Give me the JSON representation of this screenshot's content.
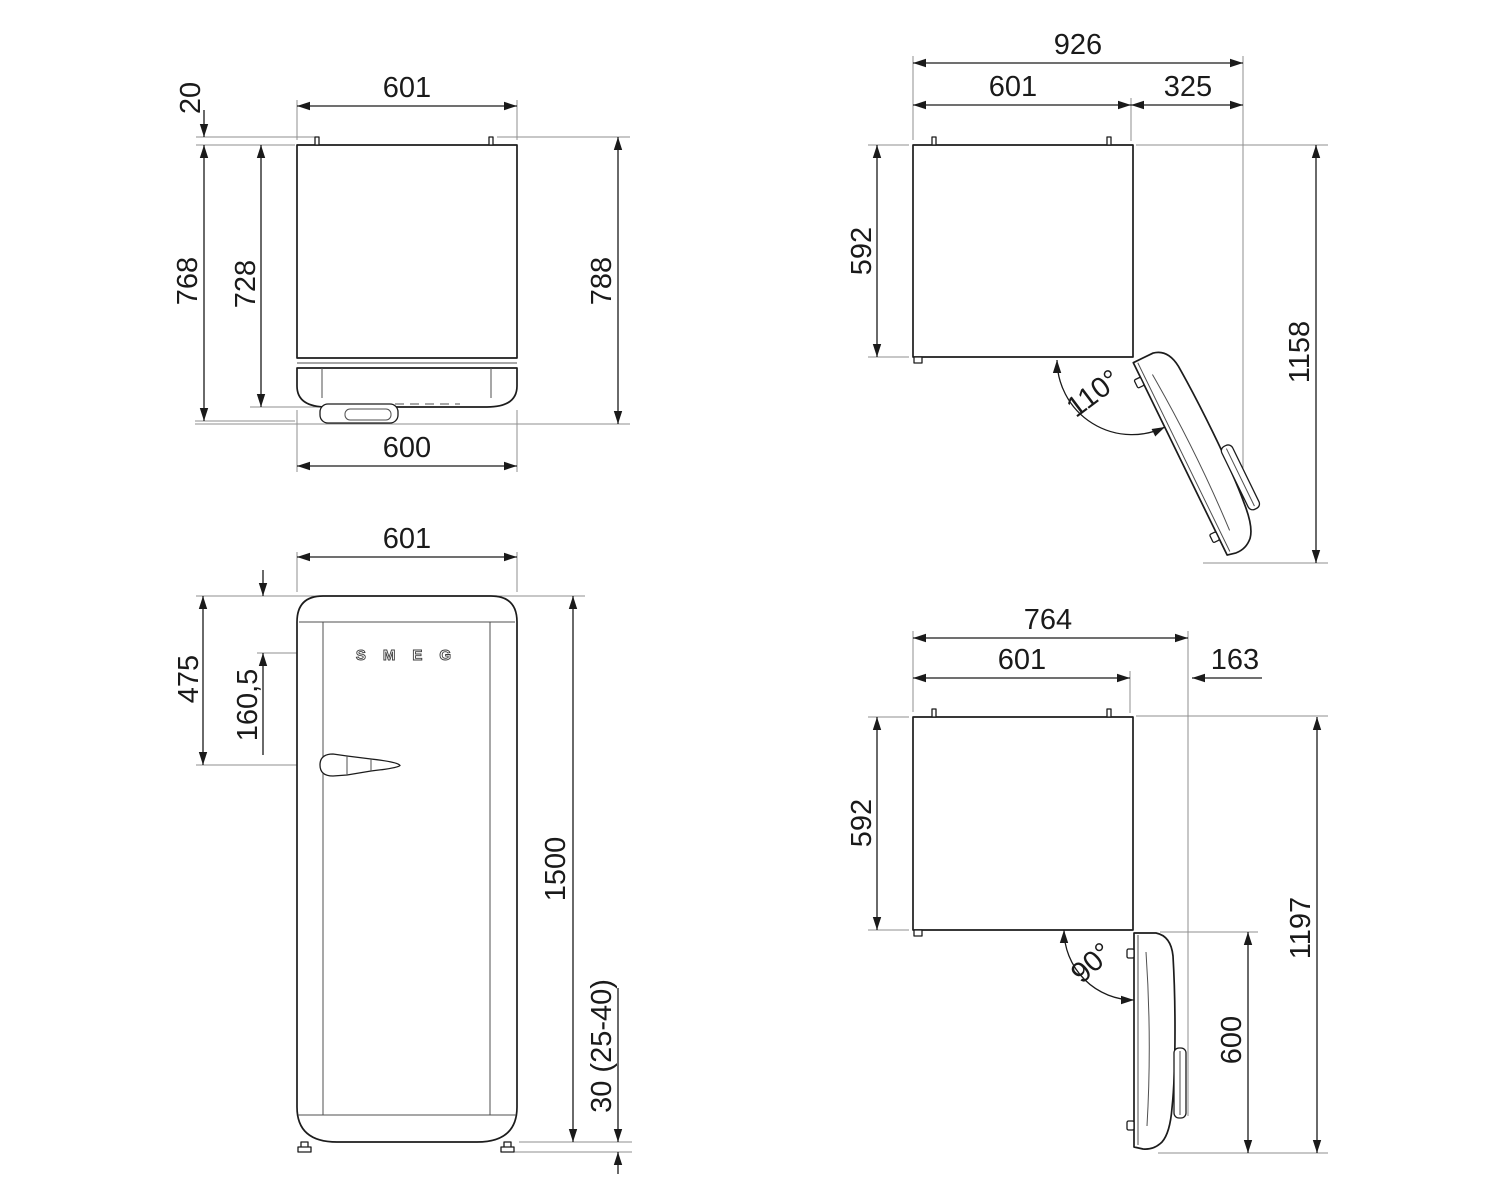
{
  "top_view": {
    "width_top": "601",
    "hinge_pin_height": "20",
    "depth_to_door_front": "768",
    "depth_cabinet": "728",
    "depth_total": "788",
    "door_width": "600"
  },
  "open_110_view": {
    "total_width": "926",
    "cabinet_width": "601",
    "door_swing_width": "325",
    "cabinet_depth": "592",
    "total_depth_door_open": "1158",
    "door_angle": "110°"
  },
  "front_view": {
    "width": "601",
    "handle_from_top": "475",
    "logo_from_top": "160,5",
    "height": "1500",
    "feet_height": "30 (25-40)",
    "logo": "SMEG"
  },
  "open_90_view": {
    "total_width": "764",
    "cabinet_width": "601",
    "door_swing_width": "163",
    "cabinet_depth": "592",
    "total_depth_door_open": "1197",
    "door_depth_open": "600",
    "door_angle": "90°"
  }
}
